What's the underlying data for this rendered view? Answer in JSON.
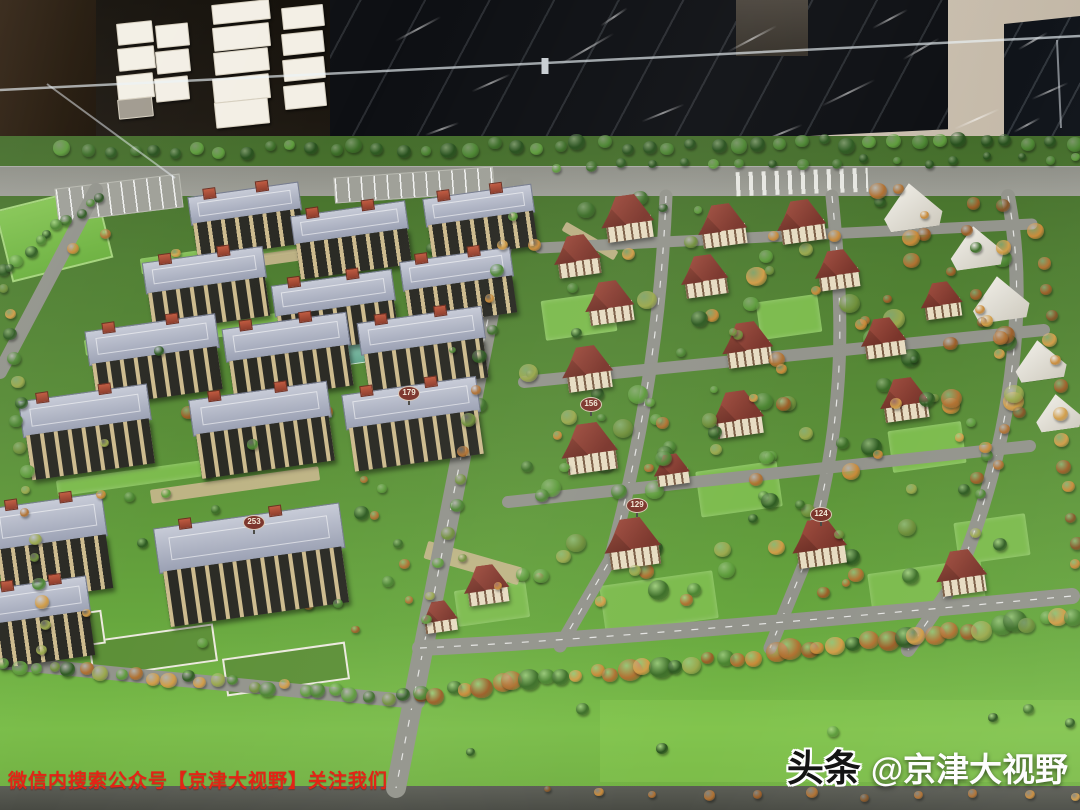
{
  "overlay": {
    "caption": "微信内搜索公众号【京津大视野】关注我们",
    "watermark_bold": "头条",
    "watermark_handle": "@京津大视野"
  },
  "colors": {
    "caption_red": "#e32416",
    "lawn_front": "#7abd49",
    "road_gray": "#93948c",
    "apartment_roof": "#a9afc0",
    "villa_roof": "#8a4136",
    "palettes": {
      "green": [
        "#2d5a21",
        "#3c6e28",
        "#4b8531",
        "#5d9c3b",
        "#27501d"
      ],
      "autumn": [
        "#b07030",
        "#c98a38",
        "#9c5d26",
        "#d19c46",
        "#845425"
      ],
      "mix": [
        "#2d5a21",
        "#3c6e28",
        "#4b8531",
        "#5d9c3b",
        "#b07030",
        "#c98a38",
        "#9c5d26",
        "#d19c46",
        "#9aa84c",
        "#6f8f3a"
      ]
    }
  },
  "background": {
    "cards": [
      {
        "l": 117,
        "t": 22,
        "w": 34,
        "h": 20
      },
      {
        "l": 118,
        "t": 47,
        "w": 35,
        "h": 21
      },
      {
        "l": 117,
        "t": 74,
        "w": 35,
        "h": 23
      },
      {
        "l": 118,
        "t": 98,
        "w": 33,
        "h": 18,
        "c": "#a09a8e"
      },
      {
        "l": 156,
        "t": 24,
        "w": 31,
        "h": 21
      },
      {
        "l": 156,
        "t": 50,
        "w": 32,
        "h": 21
      },
      {
        "l": 155,
        "t": 77,
        "w": 32,
        "h": 22
      },
      {
        "l": 212,
        "t": 2,
        "w": 56,
        "h": 18
      },
      {
        "l": 213,
        "t": 25,
        "w": 55,
        "h": 22
      },
      {
        "l": 214,
        "t": 50,
        "w": 53,
        "h": 21
      },
      {
        "l": 213,
        "t": 76,
        "w": 55,
        "h": 23
      },
      {
        "l": 215,
        "t": 100,
        "w": 52,
        "h": 24
      },
      {
        "l": 282,
        "t": 6,
        "w": 40,
        "h": 20
      },
      {
        "l": 282,
        "t": 32,
        "w": 40,
        "h": 20
      },
      {
        "l": 283,
        "t": 58,
        "w": 40,
        "h": 20
      },
      {
        "l": 284,
        "t": 84,
        "w": 40,
        "h": 22
      }
    ],
    "streaks": [
      {
        "l": 392,
        "t": 28,
        "w": 52,
        "r": -28
      },
      {
        "l": 470,
        "t": 82,
        "w": 42,
        "r": -24
      },
      {
        "l": 556,
        "t": 48,
        "w": 62,
        "r": -30
      },
      {
        "l": 640,
        "t": 112,
        "w": 46,
        "r": -22
      },
      {
        "l": 724,
        "t": 38,
        "w": 56,
        "r": -28
      },
      {
        "l": 818,
        "t": 92,
        "w": 60,
        "r": -26
      },
      {
        "l": 900,
        "t": 48,
        "w": 42,
        "r": -30
      },
      {
        "l": 952,
        "t": 118,
        "w": 50,
        "r": -24
      },
      {
        "l": 424,
        "t": 128,
        "w": 36,
        "r": -20
      },
      {
        "l": 598,
        "t": 16,
        "w": 32,
        "r": -34
      },
      {
        "l": 870,
        "t": 18,
        "w": 40,
        "r": -28
      },
      {
        "l": 760,
        "t": 132,
        "w": 44,
        "r": -22
      },
      {
        "l": 1016,
        "t": 40,
        "w": 34,
        "r": -30
      },
      {
        "l": 1030,
        "t": 90,
        "w": 40,
        "r": -24
      },
      {
        "l": 1012,
        "t": 124,
        "w": 30,
        "r": -28
      }
    ]
  },
  "model": {
    "apartments": [
      {
        "x": 247,
        "y": 220,
        "w": 112,
        "h": 62
      },
      {
        "x": 352,
        "y": 240,
        "w": 116,
        "h": 64
      },
      {
        "x": 481,
        "y": 222,
        "w": 110,
        "h": 62
      },
      {
        "x": 207,
        "y": 289,
        "w": 122,
        "h": 70
      },
      {
        "x": 336,
        "y": 312,
        "w": 122,
        "h": 70
      },
      {
        "x": 459,
        "y": 287,
        "w": 112,
        "h": 66
      },
      {
        "x": 155,
        "y": 360,
        "w": 132,
        "h": 76
      },
      {
        "x": 289,
        "y": 357,
        "w": 126,
        "h": 74
      },
      {
        "x": 424,
        "y": 350,
        "w": 126,
        "h": 72
      },
      {
        "x": 88,
        "y": 432,
        "w": 130,
        "h": 80
      },
      {
        "x": 263,
        "y": 430,
        "w": 140,
        "h": 80
      },
      {
        "x": 414,
        "y": 424,
        "w": 136,
        "h": 78
      },
      {
        "x": 52,
        "y": 548,
        "w": 114,
        "h": 96
      },
      {
        "x": 253,
        "y": 565,
        "w": 188,
        "h": 100
      },
      {
        "x": 42,
        "y": 622,
        "w": 100,
        "h": 80
      }
    ],
    "villas": [
      {
        "x": 628,
        "y": 218,
        "s": 58
      },
      {
        "x": 723,
        "y": 226,
        "s": 54
      },
      {
        "x": 802,
        "y": 222,
        "s": 54
      },
      {
        "x": 578,
        "y": 256,
        "s": 52
      },
      {
        "x": 705,
        "y": 276,
        "s": 52
      },
      {
        "x": 838,
        "y": 270,
        "s": 50
      },
      {
        "x": 610,
        "y": 303,
        "s": 54
      },
      {
        "x": 884,
        "y": 338,
        "s": 50
      },
      {
        "x": 748,
        "y": 344,
        "s": 56
      },
      {
        "x": 588,
        "y": 368,
        "s": 56
      },
      {
        "x": 942,
        "y": 300,
        "s": 46
      },
      {
        "x": 672,
        "y": 470,
        "s": 40
      },
      {
        "x": 590,
        "y": 448,
        "s": 62
      },
      {
        "x": 738,
        "y": 414,
        "s": 58
      },
      {
        "x": 905,
        "y": 400,
        "s": 54
      },
      {
        "x": 633,
        "y": 543,
        "s": 62
      },
      {
        "x": 820,
        "y": 543,
        "s": 60
      },
      {
        "x": 962,
        "y": 572,
        "s": 56
      },
      {
        "x": 487,
        "y": 585,
        "s": 50
      },
      {
        "x": 440,
        "y": 617,
        "s": 40
      }
    ],
    "tents": [
      {
        "x": 912,
        "y": 206,
        "s": 64
      },
      {
        "x": 976,
        "y": 247,
        "s": 58
      },
      {
        "x": 1000,
        "y": 298,
        "s": 62
      },
      {
        "x": 1040,
        "y": 360,
        "s": 56
      },
      {
        "x": 1058,
        "y": 412,
        "s": 50
      }
    ],
    "signs": [
      {
        "label": "253",
        "x": 253,
        "y": 521
      },
      {
        "label": "179",
        "x": 408,
        "y": 392
      },
      {
        "label": "156",
        "x": 590,
        "y": 403
      },
      {
        "label": "129",
        "x": 636,
        "y": 504
      },
      {
        "label": "124",
        "x": 820,
        "y": 513
      }
    ],
    "flats": [
      {
        "l": 2,
        "t": 197,
        "w": 100,
        "h": 70,
        "rot": -14,
        "type": "field"
      },
      {
        "l": 56,
        "t": 181,
        "w": 124,
        "h": 32,
        "rot": -7,
        "type": "parking"
      },
      {
        "l": 334,
        "t": 172,
        "w": 158,
        "h": 24,
        "rot": -4,
        "type": "parking"
      },
      {
        "l": 736,
        "t": 170,
        "w": 132,
        "h": 24,
        "rot": -2,
        "type": "cross"
      },
      {
        "l": 294,
        "t": 338,
        "w": 90,
        "h": 26,
        "rot": -8,
        "type": "pond"
      },
      {
        "l": 140,
        "t": 246,
        "w": 180,
        "h": 16,
        "rot": -8,
        "type": "lawn"
      },
      {
        "l": 84,
        "t": 326,
        "w": 200,
        "h": 16,
        "rot": -8,
        "type": "lawn"
      },
      {
        "l": 56,
        "t": 466,
        "w": 210,
        "h": 16,
        "rot": -8,
        "type": "lawn"
      },
      {
        "l": 90,
        "t": 632,
        "w": 122,
        "h": 34,
        "rot": -8,
        "type": "bed"
      },
      {
        "l": 224,
        "t": 650,
        "w": 120,
        "h": 34,
        "rot": -8,
        "type": "bed"
      },
      {
        "l": 12,
        "t": 616,
        "w": 88,
        "h": 30,
        "rot": -8,
        "type": "bed"
      },
      {
        "l": 543,
        "t": 296,
        "w": 72,
        "h": 40,
        "rot": -8,
        "type": "lawn"
      },
      {
        "l": 698,
        "t": 466,
        "w": 82,
        "h": 46,
        "rot": -8,
        "type": "lawn"
      },
      {
        "l": 890,
        "t": 426,
        "w": 74,
        "h": 42,
        "rot": -8,
        "type": "lawn"
      },
      {
        "l": 602,
        "t": 578,
        "w": 114,
        "h": 48,
        "rot": -8,
        "type": "lawn"
      },
      {
        "l": 870,
        "t": 566,
        "w": 114,
        "h": 48,
        "rot": -8,
        "type": "lawn"
      },
      {
        "l": 456,
        "t": 586,
        "w": 72,
        "h": 36,
        "rot": -8,
        "type": "lawn"
      },
      {
        "l": 758,
        "t": 298,
        "w": 62,
        "h": 38,
        "rot": -8,
        "type": "lawn"
      },
      {
        "l": 956,
        "t": 518,
        "w": 72,
        "h": 42,
        "rot": -8,
        "type": "lawn"
      },
      {
        "l": 424,
        "t": 554,
        "w": 98,
        "h": 18,
        "rot": 16,
        "type": "tan"
      },
      {
        "l": 150,
        "t": 478,
        "w": 170,
        "h": 14,
        "rot": -8,
        "type": "tan"
      },
      {
        "l": 200,
        "t": 252,
        "w": 150,
        "h": 12,
        "rot": -8,
        "type": "tan"
      },
      {
        "l": 560,
        "t": 236,
        "w": 60,
        "h": 10,
        "rot": 30,
        "type": "tan"
      },
      {
        "l": 600,
        "t": 700,
        "w": 480,
        "h": 82,
        "rot": 0,
        "type": "bright"
      }
    ],
    "roads": [
      {
        "d": "M514,186 L396,788",
        "w": 20,
        "dash": true
      },
      {
        "d": "M666,196 C662,300 648,420 610,560 L560,646",
        "w": 13,
        "dash": true
      },
      {
        "d": "M832,196 C842,300 850,410 806,560 L770,648",
        "w": 13,
        "dash": true
      },
      {
        "d": "M1008,196 C1028,300 1014,440 956,580 L908,650",
        "w": 14,
        "dash": true
      },
      {
        "d": "M540,248 L1032,224",
        "w": 11,
        "dash": false
      },
      {
        "d": "M524,382 L1044,330",
        "w": 12,
        "dash": false
      },
      {
        "d": "M508,502 L1030,446",
        "w": 12,
        "dash": false
      },
      {
        "d": "M420,648 C600,640 900,612 1072,596",
        "w": 16,
        "dash": true
      },
      {
        "d": "M96,190 L0,372",
        "w": 14,
        "dash": false
      },
      {
        "d": "M0,662 C140,676 300,692 418,702",
        "w": 14,
        "dash": false
      }
    ],
    "tree_rows": [
      {
        "x0": 66,
        "y0": 152,
        "x1": 1074,
        "y1": 141,
        "n": 46,
        "smin": 10,
        "smax": 17,
        "palette": "green",
        "seed": 7
      },
      {
        "x0": 560,
        "y0": 168,
        "x1": 1080,
        "y1": 158,
        "n": 18,
        "smin": 8,
        "smax": 12,
        "palette": "green",
        "seed": 8
      },
      {
        "x0": 4,
        "y0": 664,
        "x1": 420,
        "y1": 700,
        "n": 26,
        "smin": 10,
        "smax": 17,
        "palette": "mix",
        "seed": 21
      },
      {
        "x0": 420,
        "y0": 696,
        "x1": 1078,
        "y1": 618,
        "n": 42,
        "smin": 13,
        "smax": 25,
        "palette": "mix",
        "seed": 22
      },
      {
        "x0": 2,
        "y0": 268,
        "x1": 44,
        "y1": 648,
        "n": 18,
        "smin": 9,
        "smax": 15,
        "palette": "mix",
        "seed": 31
      },
      {
        "x0": 100,
        "y0": 196,
        "x1": 6,
        "y1": 266,
        "n": 10,
        "smin": 9,
        "smax": 14,
        "palette": "green",
        "seed": 32
      },
      {
        "x0": 1044,
        "y0": 262,
        "x1": 1076,
        "y1": 566,
        "n": 13,
        "smin": 10,
        "smax": 16,
        "palette": "autumn",
        "seed": 33
      },
      {
        "x0": 512,
        "y0": 214,
        "x1": 428,
        "y1": 624,
        "n": 15,
        "smin": 9,
        "smax": 15,
        "palette": "mix",
        "seed": 34
      },
      {
        "x0": 544,
        "y0": 792,
        "x1": 1080,
        "y1": 796,
        "n": 11,
        "smin": 7,
        "smax": 12,
        "palette": "autumn",
        "seed": 44
      }
    ],
    "tree_clusters": [
      {
        "x0": 522,
        "y0": 198,
        "x1": 1026,
        "y1": 608,
        "n": 75,
        "smin": 9,
        "smax": 22,
        "palette": "mix",
        "seed": 41,
        "layer": "under"
      },
      {
        "x0": 56,
        "y0": 228,
        "x1": 505,
        "y1": 640,
        "n": 30,
        "smin": 8,
        "smax": 16,
        "palette": "mix",
        "seed": 42,
        "layer": "under"
      },
      {
        "x0": 522,
        "y0": 200,
        "x1": 1026,
        "y1": 612,
        "n": 48,
        "smin": 8,
        "smax": 18,
        "palette": "mix",
        "seed": 45,
        "layer": "over"
      },
      {
        "x0": 60,
        "y0": 240,
        "x1": 500,
        "y1": 648,
        "n": 16,
        "smin": 7,
        "smax": 13,
        "palette": "mix",
        "seed": 46,
        "layer": "over"
      },
      {
        "x0": 860,
        "y0": 180,
        "x1": 1040,
        "y1": 430,
        "n": 22,
        "smin": 9,
        "smax": 18,
        "palette": "autumn",
        "seed": 47,
        "layer": "over"
      },
      {
        "x0": 430,
        "y0": 706,
        "x1": 1070,
        "y1": 768,
        "n": 7,
        "smin": 8,
        "smax": 13,
        "palette": "green",
        "seed": 43,
        "layer": "over"
      }
    ]
  }
}
